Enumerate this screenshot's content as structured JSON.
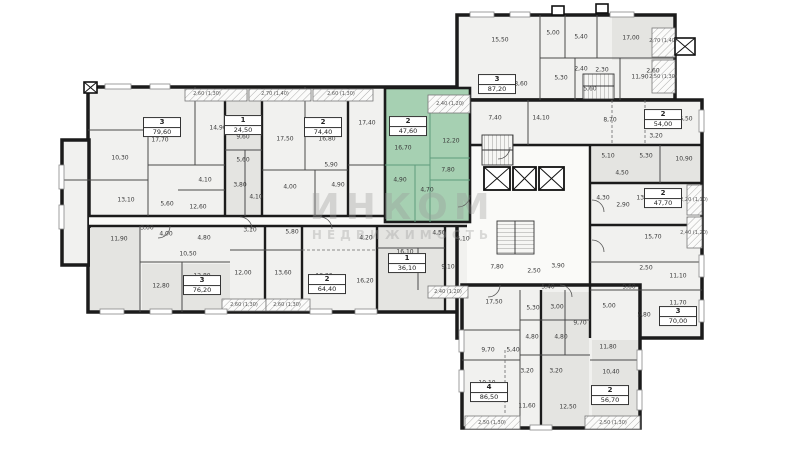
{
  "watermark": {
    "line1": "ИНКОМ",
    "line2": "НЕДВИЖИМОСТЬ"
  },
  "colors": {
    "wall": "#1b1b1b",
    "room_fill": "#f1f1ef",
    "room_fill_dark": "#e4e4e1",
    "highlight": "#a6d0b2",
    "highlight_line": "#5f9c7c",
    "label": "#3a3a3a",
    "watermark": "#9a9a9a",
    "corridor": "#fafaf8"
  },
  "selected_unit": {
    "rooms": "2",
    "area": "47,60"
  },
  "units": [
    {
      "n": "3",
      "a": "79,60",
      "x": 162,
      "y": 127,
      "sel": false
    },
    {
      "n": "1",
      "a": "24,50",
      "x": 243,
      "y": 125,
      "sel": false
    },
    {
      "n": "2",
      "a": "74,40",
      "x": 323,
      "y": 127,
      "sel": false
    },
    {
      "n": "2",
      "a": "47,60",
      "x": 408,
      "y": 126,
      "sel": true
    },
    {
      "n": "3",
      "a": "87,20",
      "x": 497,
      "y": 84,
      "sel": false
    },
    {
      "n": "2",
      "a": "54,00",
      "x": 663,
      "y": 119,
      "sel": false
    },
    {
      "n": "2",
      "a": "47,70",
      "x": 663,
      "y": 198,
      "sel": false
    },
    {
      "n": "3",
      "a": "70,00",
      "x": 678,
      "y": 316,
      "sel": false
    },
    {
      "n": "2",
      "a": "56,70",
      "x": 610,
      "y": 395,
      "sel": false
    },
    {
      "n": "4",
      "a": "86,50",
      "x": 489,
      "y": 392,
      "sel": false
    },
    {
      "n": "1",
      "a": "36,10",
      "x": 407,
      "y": 263,
      "sel": false
    },
    {
      "n": "2",
      "a": "64,40",
      "x": 327,
      "y": 284,
      "sel": false
    },
    {
      "n": "3",
      "a": "76,20",
      "x": 202,
      "y": 285,
      "sel": false
    }
  ],
  "room_labels": [
    {
      "t": "17,70",
      "x": 160,
      "y": 140
    },
    {
      "t": "14,90",
      "x": 218,
      "y": 128
    },
    {
      "t": "10,30",
      "x": 120,
      "y": 158
    },
    {
      "t": "13,10",
      "x": 126,
      "y": 200
    },
    {
      "t": "5,60",
      "x": 167,
      "y": 204
    },
    {
      "t": "4,10",
      "x": 205,
      "y": 180
    },
    {
      "t": "12,60",
      "x": 198,
      "y": 207
    },
    {
      "t": "9,60",
      "x": 243,
      "y": 137
    },
    {
      "t": "5,60",
      "x": 243,
      "y": 160
    },
    {
      "t": "3,80",
      "x": 240,
      "y": 185
    },
    {
      "t": "4,10",
      "x": 256,
      "y": 197
    },
    {
      "t": "17,50",
      "x": 285,
      "y": 139
    },
    {
      "t": "16,80",
      "x": 327,
      "y": 139
    },
    {
      "t": "5,90",
      "x": 331,
      "y": 165
    },
    {
      "t": "4,00",
      "x": 290,
      "y": 187
    },
    {
      "t": "4,90",
      "x": 338,
      "y": 185
    },
    {
      "t": "17,40",
      "x": 367,
      "y": 123
    },
    {
      "t": "16,70",
      "x": 403,
      "y": 148
    },
    {
      "t": "12,20",
      "x": 451,
      "y": 141
    },
    {
      "t": "7,80",
      "x": 448,
      "y": 170
    },
    {
      "t": "4,90",
      "x": 400,
      "y": 180
    },
    {
      "t": "4,70",
      "x": 427,
      "y": 190
    },
    {
      "t": "15,50",
      "x": 500,
      "y": 40
    },
    {
      "t": "5,00",
      "x": 553,
      "y": 33
    },
    {
      "t": "5,40",
      "x": 581,
      "y": 37
    },
    {
      "t": "17,00",
      "x": 631,
      "y": 38
    },
    {
      "t": "18,60",
      "x": 519,
      "y": 84
    },
    {
      "t": "2,40",
      "x": 581,
      "y": 69
    },
    {
      "t": "2,30",
      "x": 602,
      "y": 70
    },
    {
      "t": "11,90",
      "x": 640,
      "y": 77
    },
    {
      "t": "5,30",
      "x": 561,
      "y": 78
    },
    {
      "t": "5,60",
      "x": 590,
      "y": 89
    },
    {
      "t": "2,60",
      "x": 653,
      "y": 71
    },
    {
      "t": "7,40",
      "x": 495,
      "y": 118
    },
    {
      "t": "14,10",
      "x": 541,
      "y": 118
    },
    {
      "t": "3,20",
      "x": 656,
      "y": 136
    },
    {
      "t": "8,70",
      "x": 610,
      "y": 120
    },
    {
      "t": "16,50",
      "x": 684,
      "y": 119
    },
    {
      "t": "5,10",
      "x": 608,
      "y": 156
    },
    {
      "t": "5,30",
      "x": 646,
      "y": 156
    },
    {
      "t": "10,90",
      "x": 684,
      "y": 159
    },
    {
      "t": "4,50",
      "x": 622,
      "y": 173
    },
    {
      "t": "4,30",
      "x": 603,
      "y": 198
    },
    {
      "t": "2,90",
      "x": 623,
      "y": 205
    },
    {
      "t": "13,60",
      "x": 645,
      "y": 198
    },
    {
      "t": "15,70",
      "x": 653,
      "y": 237
    },
    {
      "t": "2,50",
      "x": 646,
      "y": 268
    },
    {
      "t": "11,10",
      "x": 678,
      "y": 276
    },
    {
      "t": "9,60",
      "x": 629,
      "y": 287
    },
    {
      "t": "11,70",
      "x": 678,
      "y": 303
    },
    {
      "t": "5,80",
      "x": 644,
      "y": 315
    },
    {
      "t": "5,00",
      "x": 609,
      "y": 306
    },
    {
      "t": "5,10",
      "x": 463,
      "y": 239
    },
    {
      "t": "7,80",
      "x": 497,
      "y": 267
    },
    {
      "t": "2,50",
      "x": 534,
      "y": 271
    },
    {
      "t": "3,90",
      "x": 558,
      "y": 266
    },
    {
      "t": "5,40",
      "x": 548,
      "y": 287
    },
    {
      "t": "17,50",
      "x": 494,
      "y": 302
    },
    {
      "t": "5,30",
      "x": 533,
      "y": 308
    },
    {
      "t": "3,00",
      "x": 557,
      "y": 307
    },
    {
      "t": "9,70",
      "x": 580,
      "y": 323
    },
    {
      "t": "4,80",
      "x": 532,
      "y": 337
    },
    {
      "t": "4,80",
      "x": 561,
      "y": 337
    },
    {
      "t": "9,70",
      "x": 488,
      "y": 350
    },
    {
      "t": "5,40",
      "x": 513,
      "y": 350
    },
    {
      "t": "3,20",
      "x": 527,
      "y": 371
    },
    {
      "t": "3,20",
      "x": 556,
      "y": 371
    },
    {
      "t": "10,10",
      "x": 487,
      "y": 383
    },
    {
      "t": "11,60",
      "x": 527,
      "y": 406
    },
    {
      "t": "12,50",
      "x": 568,
      "y": 407
    },
    {
      "t": "11,80",
      "x": 608,
      "y": 347
    },
    {
      "t": "10,40",
      "x": 611,
      "y": 372
    },
    {
      "t": "11,90",
      "x": 119,
      "y": 239
    },
    {
      "t": "3,00",
      "x": 147,
      "y": 228
    },
    {
      "t": "4,00",
      "x": 166,
      "y": 234
    },
    {
      "t": "4,80",
      "x": 204,
      "y": 238
    },
    {
      "t": "10,50",
      "x": 188,
      "y": 254
    },
    {
      "t": "12,80",
      "x": 161,
      "y": 286
    },
    {
      "t": "12,80",
      "x": 202,
      "y": 276
    },
    {
      "t": "12,00",
      "x": 243,
      "y": 273
    },
    {
      "t": "13,60",
      "x": 283,
      "y": 273
    },
    {
      "t": "3,10",
      "x": 250,
      "y": 230
    },
    {
      "t": "5,80",
      "x": 292,
      "y": 232
    },
    {
      "t": "4,20",
      "x": 366,
      "y": 238
    },
    {
      "t": "13,20",
      "x": 324,
      "y": 276
    },
    {
      "t": "16,20",
      "x": 365,
      "y": 281
    },
    {
      "t": "4,50",
      "x": 439,
      "y": 233
    },
    {
      "t": "16,10",
      "x": 405,
      "y": 252
    },
    {
      "t": "9,10",
      "x": 448,
      "y": 267
    }
  ],
  "balcony_labels": [
    {
      "t": "2,60 (1,30)",
      "x": 207,
      "y": 94
    },
    {
      "t": "2,70 (1,40)",
      "x": 275,
      "y": 94
    },
    {
      "t": "2,60 (1,30)",
      "x": 341,
      "y": 94
    },
    {
      "t": "2,40 (1,20)",
      "x": 450,
      "y": 104
    },
    {
      "t": "2,70 (1,40)",
      "x": 663,
      "y": 41
    },
    {
      "t": "2,50 (1,30)",
      "x": 663,
      "y": 77
    },
    {
      "t": "2,20 (1,10)",
      "x": 694,
      "y": 200
    },
    {
      "t": "2,40 (1,20)",
      "x": 694,
      "y": 233
    },
    {
      "t": "2,40 (1,20)",
      "x": 448,
      "y": 292
    },
    {
      "t": "2,60 (1,30)",
      "x": 244,
      "y": 305
    },
    {
      "t": "2,60 (1,30)",
      "x": 287,
      "y": 305
    },
    {
      "t": "2,50 (1,30)",
      "x": 492,
      "y": 423
    },
    {
      "t": "2,50 (1,30)",
      "x": 613,
      "y": 423
    }
  ]
}
